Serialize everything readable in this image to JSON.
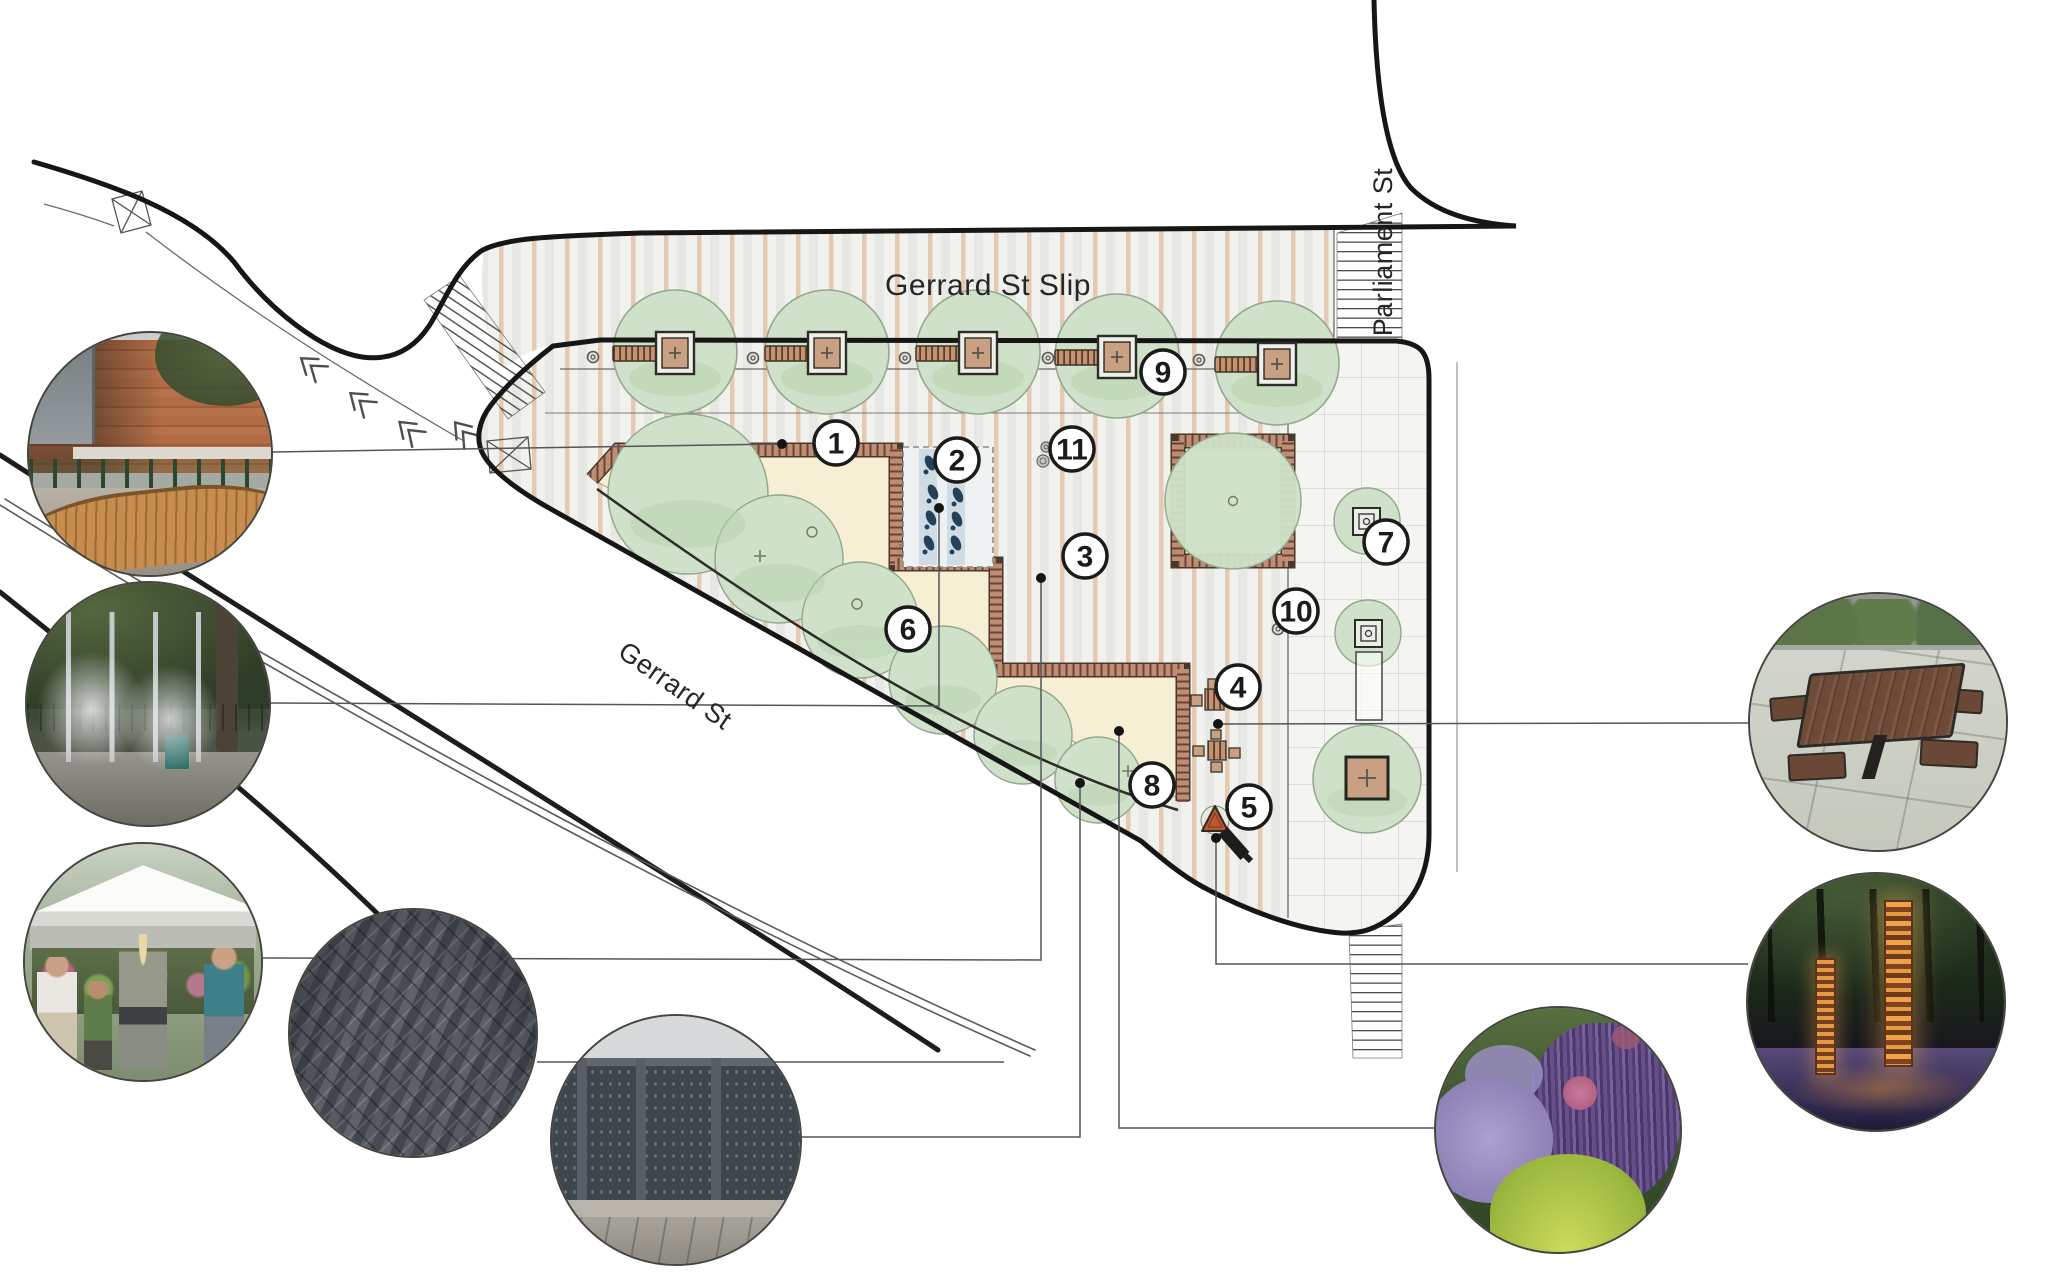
{
  "canvas": {
    "width": 2048,
    "height": 1276,
    "background": "#ffffff"
  },
  "labels": {
    "gerrard_slip": "Gerrard St Slip",
    "gerrard": "Gerrard St",
    "parliament": "Parliament St"
  },
  "marker_style": {
    "radius": 22,
    "fill": "#ffffff",
    "stroke": "#1b1b1b",
    "number_color": "#1b1b1b"
  },
  "markers": [
    {
      "n": "1",
      "x": 836,
      "y": 443
    },
    {
      "n": "2",
      "x": 957,
      "y": 460
    },
    {
      "n": "3",
      "x": 1085,
      "y": 556
    },
    {
      "n": "4",
      "x": 1238,
      "y": 687
    },
    {
      "n": "5",
      "x": 1249,
      "y": 807
    },
    {
      "n": "6",
      "x": 908,
      "y": 629
    },
    {
      "n": "7",
      "x": 1386,
      "y": 542
    },
    {
      "n": "8",
      "x": 1152,
      "y": 785
    },
    {
      "n": "9",
      "x": 1163,
      "y": 372
    },
    {
      "n": "10",
      "x": 1296,
      "y": 611
    },
    {
      "n": "11",
      "x": 1072,
      "y": 449
    }
  ],
  "photos": [
    {
      "id": "bench",
      "name": "curved-bench-photo",
      "depicts": "curved wood bench beside brick wall",
      "cx": 150,
      "cy": 454,
      "r": 123
    },
    {
      "id": "mist",
      "name": "water-mist-plaza-photo",
      "depicts": "misting water feature posts under trees",
      "cx": 148,
      "cy": 704,
      "r": 123
    },
    {
      "id": "market",
      "name": "market-tents-photo",
      "depicts": "pop-up market tent with shoppers and plants",
      "cx": 143,
      "cy": 962,
      "r": 120
    },
    {
      "id": "herr",
      "name": "herringbone-paving-photo",
      "depicts": "dark herringbone unit paving",
      "cx": 413,
      "cy": 1033,
      "r": 125
    },
    {
      "id": "fence",
      "name": "metal-screen-fence-photo",
      "depicts": "laser-cut metal screen fence panels",
      "cx": 676,
      "cy": 1140,
      "r": 126
    },
    {
      "id": "plant",
      "name": "perennial-planting-photo",
      "depicts": "purple salvia and grasses planting",
      "cx": 1558,
      "cy": 1130,
      "r": 124
    },
    {
      "id": "picnic",
      "name": "picnic-table-photo",
      "depicts": "square picnic table with four seats",
      "cx": 1878,
      "cy": 722,
      "r": 130
    },
    {
      "id": "light",
      "name": "corten-light-columns-photo",
      "depicts": "glowing corten steel light columns at night",
      "cx": 1876,
      "cy": 1002,
      "r": 130
    }
  ],
  "leaders": [
    {
      "to": "bench",
      "points": [
        [
          272,
          452
        ],
        [
          782,
          444
        ]
      ],
      "dot": [
        782,
        444
      ]
    },
    {
      "to": "mist",
      "points": [
        [
          270,
          703
        ],
        [
          939,
          706
        ],
        [
          939,
          509
        ]
      ],
      "dot": [
        939,
        508
      ]
    },
    {
      "to": "market",
      "points": [
        [
          262,
          958
        ],
        [
          1041,
          960
        ],
        [
          1041,
          579
        ]
      ],
      "dot": [
        1041,
        578
      ]
    },
    {
      "to": "herr",
      "points": [
        [
          537,
          1062
        ],
        [
          1004,
          1062
        ]
      ],
      "dot": null
    },
    {
      "to": "fence",
      "points": [
        [
          801,
          1137
        ],
        [
          1080,
          1137
        ],
        [
          1080,
          784
        ]
      ],
      "dot": [
        1080,
        783
      ]
    },
    {
      "to": "plant",
      "points": [
        [
          1434,
          1128
        ],
        [
          1119,
          1128
        ],
        [
          1119,
          732
        ]
      ],
      "dot": [
        1119,
        731
      ]
    },
    {
      "to": "picnic",
      "points": [
        [
          1749,
          723
        ],
        [
          1218,
          724
        ]
      ],
      "dot": [
        1218,
        724
      ]
    },
    {
      "to": "light",
      "points": [
        [
          1748,
          964
        ],
        [
          1216,
          964
        ],
        [
          1216,
          839
        ]
      ],
      "dot": [
        1216,
        838
      ]
    }
  ],
  "plan": {
    "slip_trees": [
      [
        675,
        352
      ],
      [
        827,
        352
      ],
      [
        978,
        352
      ],
      [
        1117,
        356
      ],
      [
        1277,
        363
      ]
    ],
    "bollards": [
      [
        593,
        357
      ],
      [
        753,
        358
      ],
      [
        905,
        358
      ],
      [
        1048,
        358
      ],
      [
        1199,
        360
      ],
      [
        1278,
        629
      ]
    ],
    "pebbles": [
      [
        1046,
        447,
        5
      ],
      [
        1043,
        461,
        6
      ]
    ],
    "splash_jets": [
      [
        930,
        463
      ],
      [
        933,
        492
      ],
      [
        931,
        518
      ],
      [
        929,
        543
      ],
      [
        958,
        495
      ],
      [
        957,
        519
      ],
      [
        956,
        543
      ]
    ],
    "tree_plus_marks": [
      [
        905,
        545
      ],
      [
        760,
        556
      ],
      [
        1128,
        771
      ]
    ],
    "chevrons": [
      [
        306,
        362,
        38
      ],
      [
        355,
        397,
        40
      ],
      [
        404,
        426,
        42
      ],
      [
        459,
        427,
        50
      ]
    ]
  },
  "colors": {
    "boundary": "#161616",
    "deck_stripe_tan": "#e1c0a4",
    "deck_stripe_grey": "#dddddb",
    "deck_bg": "#f1f1ee",
    "paver_bg": "#f4f4f1",
    "paver_line": "#d4d4cf",
    "tree_fill": "#cfe2c9",
    "tree_edge": "#95a78e",
    "lawn": "#f6efd3",
    "seatwall_brick": "#bd8e74",
    "seatwall_hatch": "#6b4234",
    "planter_wood": "#c9a182",
    "splash_band": "#ccd9e2",
    "splash_jet": "#24415a",
    "art_triangle": "#bf5632",
    "leader": "#55555a"
  }
}
